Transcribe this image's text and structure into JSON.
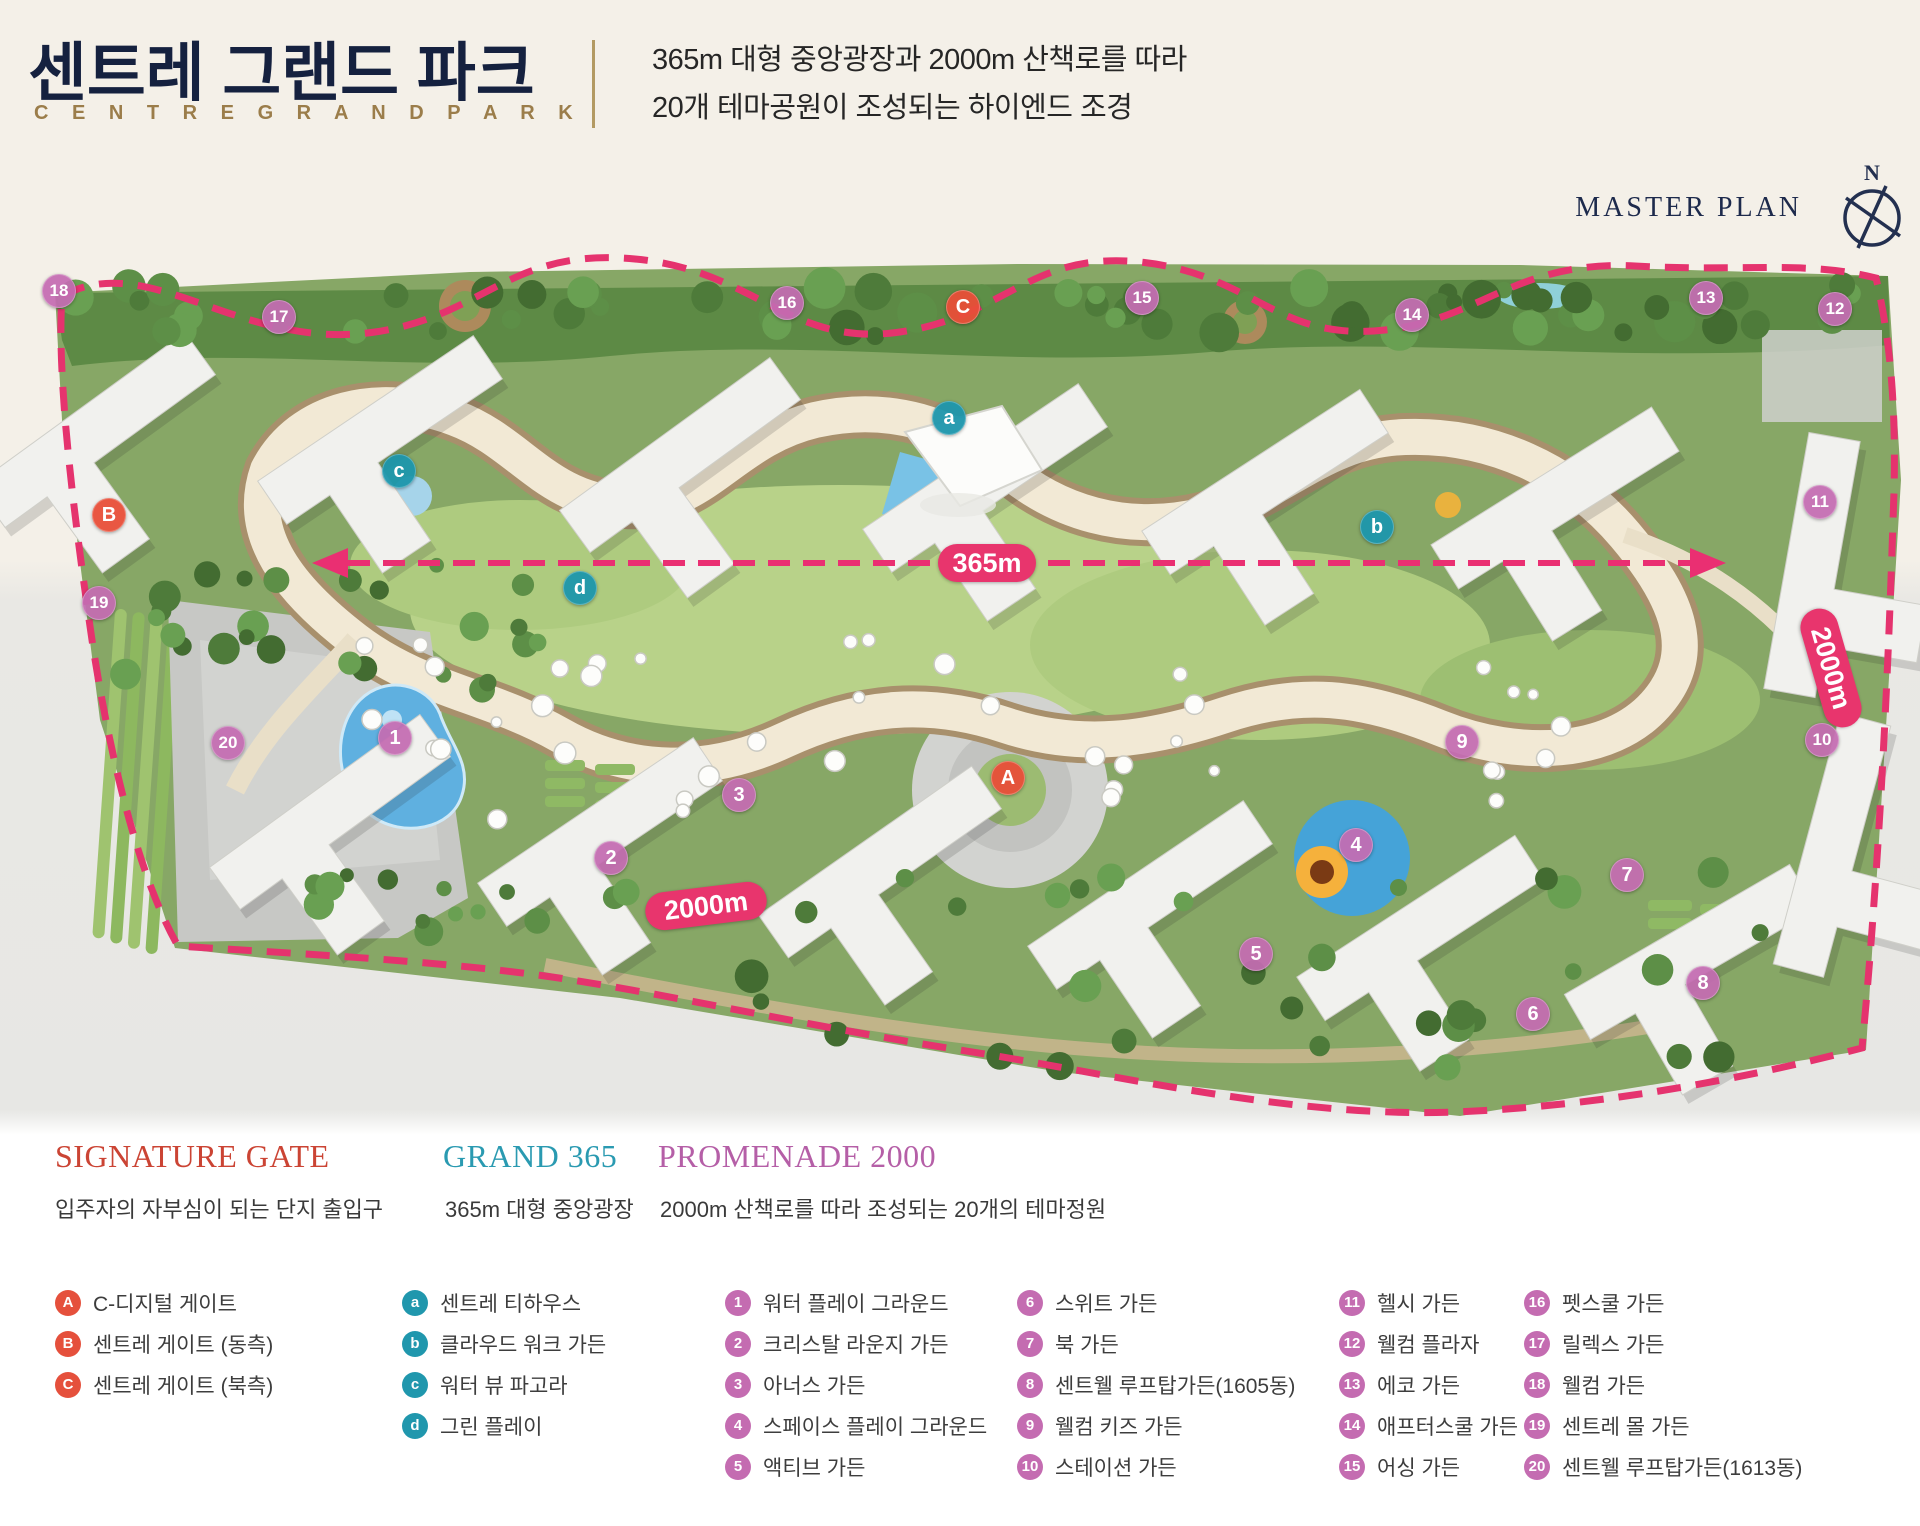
{
  "header": {
    "title_ko": "센트레 그랜드 파크",
    "title_en": "C E N T R E   G R A N D   P A R K",
    "subtitle_line1": "365m 대형 중앙광장과 2000m 산책로를 따라",
    "subtitle_line2": "20개 테마공원이 조성되는 하이엔드 조경",
    "master_plan_label": "MASTER PLAN",
    "compass_north": "N"
  },
  "map": {
    "labels": {
      "central_axis": "365m",
      "promenade_bottom": "2000m",
      "promenade_right": "2000m"
    },
    "badges": [
      {
        "label": "18",
        "type": "promenade",
        "x": 59,
        "y": 291
      },
      {
        "label": "17",
        "type": "promenade",
        "x": 279,
        "y": 317
      },
      {
        "label": "16",
        "type": "promenade",
        "x": 787,
        "y": 303
      },
      {
        "label": "C",
        "type": "gate",
        "x": 963,
        "y": 307
      },
      {
        "label": "15",
        "type": "promenade",
        "x": 1142,
        "y": 298
      },
      {
        "label": "14",
        "type": "promenade",
        "x": 1412,
        "y": 315
      },
      {
        "label": "13",
        "type": "promenade",
        "x": 1706,
        "y": 298
      },
      {
        "label": "12",
        "type": "promenade",
        "x": 1835,
        "y": 309
      },
      {
        "label": "a",
        "type": "grand",
        "x": 949,
        "y": 418
      },
      {
        "label": "c",
        "type": "grand",
        "x": 399,
        "y": 471
      },
      {
        "label": "B",
        "type": "gate",
        "x": 109,
        "y": 515
      },
      {
        "label": "11",
        "type": "promenade",
        "x": 1820,
        "y": 502
      },
      {
        "label": "b",
        "type": "grand",
        "x": 1377,
        "y": 527
      },
      {
        "label": "d",
        "type": "grand",
        "x": 580,
        "y": 588
      },
      {
        "label": "19",
        "type": "promenade",
        "x": 99,
        "y": 603
      },
      {
        "label": "10",
        "type": "promenade",
        "x": 1822,
        "y": 740
      },
      {
        "label": "20",
        "type": "promenade",
        "x": 228,
        "y": 743
      },
      {
        "label": "1",
        "type": "promenade",
        "x": 395,
        "y": 738
      },
      {
        "label": "9",
        "type": "promenade",
        "x": 1462,
        "y": 742
      },
      {
        "label": "A",
        "type": "gate",
        "x": 1008,
        "y": 778
      },
      {
        "label": "3",
        "type": "promenade",
        "x": 739,
        "y": 795
      },
      {
        "label": "2",
        "type": "promenade",
        "x": 611,
        "y": 858
      },
      {
        "label": "4",
        "type": "promenade",
        "x": 1356,
        "y": 845
      },
      {
        "label": "7",
        "type": "promenade",
        "x": 1627,
        "y": 875
      },
      {
        "label": "5",
        "type": "promenade",
        "x": 1256,
        "y": 954
      },
      {
        "label": "8",
        "type": "promenade",
        "x": 1703,
        "y": 983
      },
      {
        "label": "6",
        "type": "promenade",
        "x": 1533,
        "y": 1014
      }
    ]
  },
  "legend": {
    "signature": {
      "title": "SIGNATURE GATE",
      "subtitle": "입주자의 자부심이 되는 단지 출입구",
      "title_color": "#cb4434",
      "items": [
        {
          "badge": "A",
          "label": "C-디지털 게이트"
        },
        {
          "badge": "B",
          "label": "센트레 게이트 (동측)"
        },
        {
          "badge": "C",
          "label": "센트레 게이트 (북측)"
        }
      ]
    },
    "grand": {
      "title": "GRAND 365",
      "subtitle": "365m 대형 중앙광장",
      "title_color": "#2a9ab1",
      "items": [
        {
          "badge": "a",
          "label": "센트레 티하우스"
        },
        {
          "badge": "b",
          "label": "클라우드 워크 가든"
        },
        {
          "badge": "c",
          "label": "워터 뷰 파고라"
        },
        {
          "badge": "d",
          "label": "그린 플레이"
        }
      ]
    },
    "promenade": {
      "title": "PROMENADE 2000",
      "subtitle": "2000m 산책로를 따라 조성되는 20개의 테마정원",
      "title_color": "#b55fa7",
      "columns": [
        [
          {
            "badge": "1",
            "label": "워터 플레이 그라운드"
          },
          {
            "badge": "2",
            "label": "크리스탈 라운지 가든"
          },
          {
            "badge": "3",
            "label": "아너스 가든"
          },
          {
            "badge": "4",
            "label": "스페이스 플레이 그라운드"
          },
          {
            "badge": "5",
            "label": "액티브 가든"
          }
        ],
        [
          {
            "badge": "6",
            "label": "스위트 가든"
          },
          {
            "badge": "7",
            "label": "북 가든"
          },
          {
            "badge": "8",
            "label": "센트웰 루프탑가든(1605동)"
          },
          {
            "badge": "9",
            "label": "웰컴 키즈 가든"
          },
          {
            "badge": "10",
            "label": "스테이션 가든"
          }
        ],
        [
          {
            "badge": "11",
            "label": "헬시 가든"
          },
          {
            "badge": "12",
            "label": "웰컴 플라자"
          },
          {
            "badge": "13",
            "label": "에코 가든"
          },
          {
            "badge": "14",
            "label": "애프터스쿨 가든"
          },
          {
            "badge": "15",
            "label": "어싱 가든"
          }
        ],
        [
          {
            "badge": "16",
            "label": "펫스쿨 가든"
          },
          {
            "badge": "17",
            "label": "릴렉스 가든"
          },
          {
            "badge": "18",
            "label": "웰컴 가든"
          },
          {
            "badge": "19",
            "label": "센트레 몰 가든"
          },
          {
            "badge": "20",
            "label": "센트웰 루프탑가든(1613동)"
          }
        ]
      ]
    }
  },
  "colors": {
    "accent_navy": "#15213f",
    "accent_gold": "#9b7d4a",
    "route_pink": "#e5336e",
    "badge_gate": "#e5503c",
    "badge_grand": "#2097ad",
    "badge_promenade": "#c46cb1",
    "site_green": "#87a766",
    "bg_cream": "#f4f0e8"
  }
}
